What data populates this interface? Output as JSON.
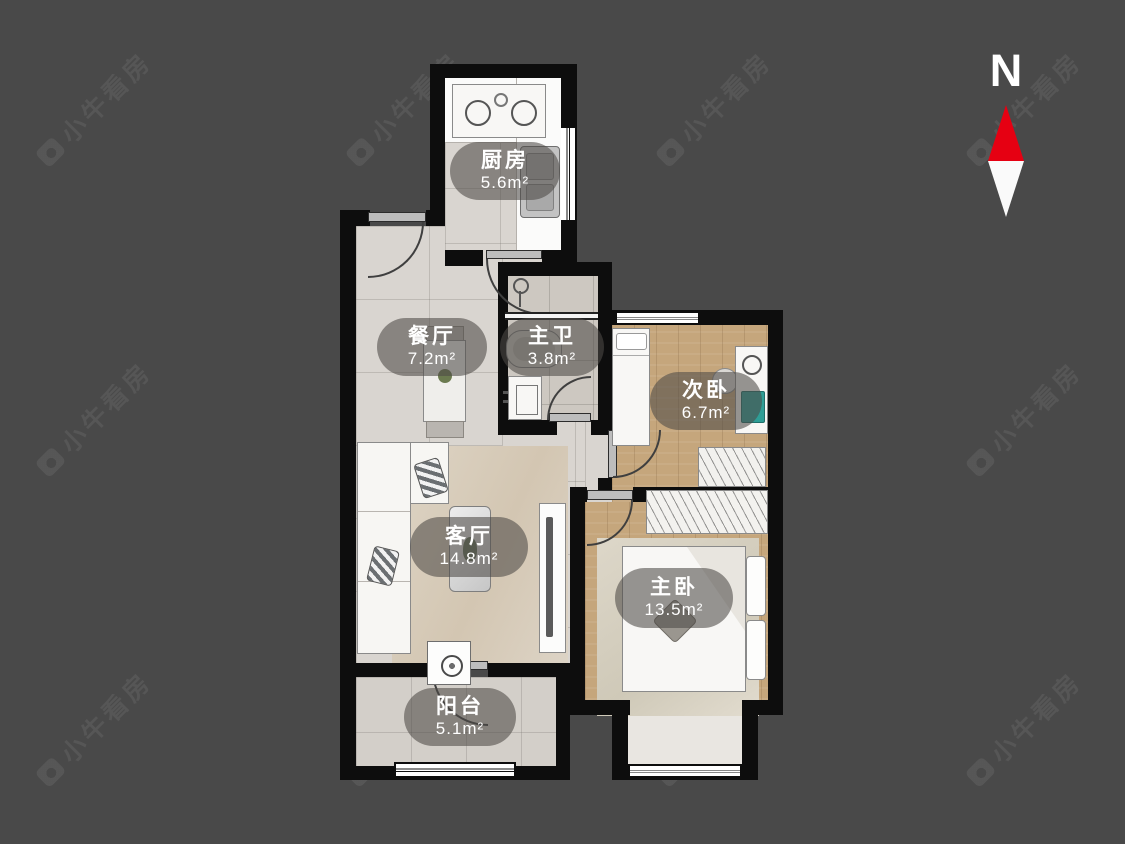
{
  "watermark": {
    "text": "小牛看房"
  },
  "compass": {
    "label": "N"
  },
  "rooms": {
    "kitchen": {
      "name": "厨房",
      "area": "5.6m²"
    },
    "dining": {
      "name": "餐厅",
      "area": "7.2m²"
    },
    "bathroom": {
      "name": "主卫",
      "area": "3.8m²"
    },
    "secondary_bedroom": {
      "name": "次卧",
      "area": "6.7m²"
    },
    "living": {
      "name": "客厅",
      "area": "14.8m²"
    },
    "master_bedroom": {
      "name": "主卧",
      "area": "13.5m²"
    },
    "balcony": {
      "name": "阳台",
      "area": "5.1m²"
    }
  }
}
